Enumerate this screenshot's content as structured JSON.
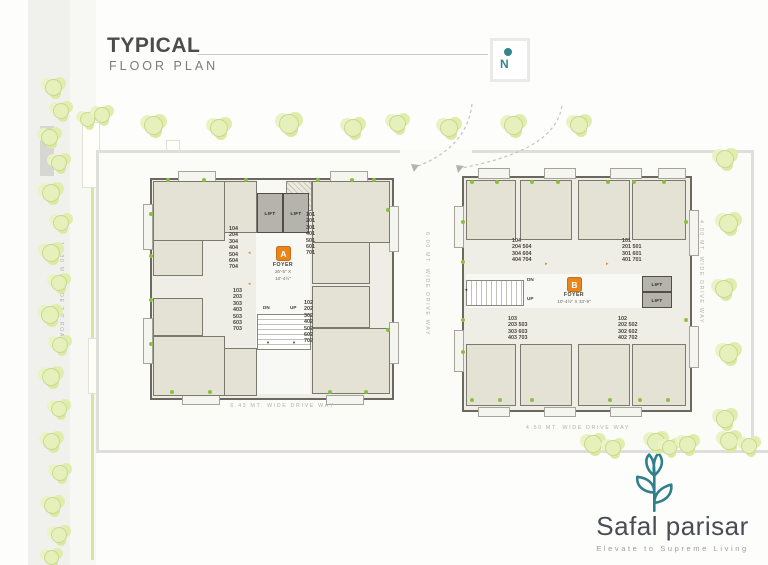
{
  "header": {
    "title": "TYPICAL",
    "subtitle": "FLOOR PLAN"
  },
  "north": {
    "label": "N"
  },
  "roads": {
    "tp_road": "18.30 MT. WIDE T.P.ROAD",
    "drive_below_a": "6.43 MT. WIDE DRIVE WAY",
    "drive_below_b": "4.50 MT. WIDE DRIVE WAY",
    "drive_between": "6.00 MT. WIDE DRIVE WAY",
    "drive_right": "4.00 MT. WIDE DRIVE WAY"
  },
  "block_a": {
    "badge": "A",
    "foyer": "FOYER",
    "dim_line1": "26'-5\" X",
    "dim_line2": "10'-4½\"",
    "lift_left": "LIFT",
    "lift_right": "LIFT",
    "dn": "DN",
    "up": "UP",
    "units_top_left": [
      "104",
      "204",
      "304",
      "404",
      "504",
      "604",
      "704"
    ],
    "units_top_right": [
      "101",
      "201",
      "301",
      "401",
      "501",
      "601",
      "701"
    ],
    "units_bottom_left": [
      "103",
      "203",
      "303",
      "403",
      "503",
      "603",
      "703"
    ],
    "units_bottom_right": [
      "102",
      "202",
      "302",
      "402",
      "502",
      "602",
      "702"
    ]
  },
  "block_b": {
    "badge": "B",
    "foyer": "FOYER",
    "dim": "10'-4½\" X 33'-9\"",
    "lift_top": "LIFT",
    "lift_bottom": "LIFT",
    "dn": "DN",
    "up": "UP",
    "units_top_left": [
      "104",
      "204 504",
      "304 604",
      "404 704"
    ],
    "units_top_right": [
      "101",
      "201 501",
      "301 601",
      "401 701"
    ],
    "units_bottom_left": [
      "103",
      "203 503",
      "303 603",
      "403 703"
    ],
    "units_bottom_right": [
      "102",
      "202 502",
      "302 602",
      "402 702"
    ]
  },
  "logo": {
    "name": "Safal parisar",
    "tagline": "Elevate to Supreme Living"
  },
  "colors": {
    "accent_orange": "#e8851d",
    "accent_teal": "#37858f",
    "tree": "#e6f0ba",
    "wall": "#6b695f"
  }
}
